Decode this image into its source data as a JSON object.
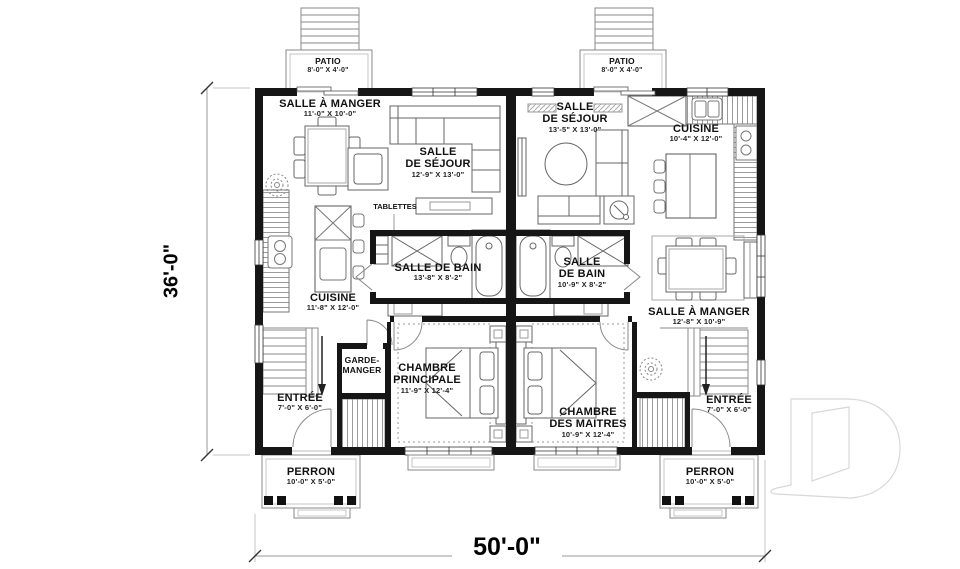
{
  "dimensions": {
    "overall_width": "50'-0\"",
    "overall_depth": "36'-0\""
  },
  "watermark_letter": "D",
  "left_unit": {
    "patio": {
      "name": "PATIO",
      "size": "8'-0\" X 4'-0\""
    },
    "dining": {
      "name": "SALLE À MANGER",
      "size": "11'-0\" X 10'-0\""
    },
    "living": {
      "line1": "SALLE",
      "line2": "DE SÉJOUR",
      "size": "12'-9\" X 13'-0\""
    },
    "shelves_label": "TABLETTES",
    "kitchen": {
      "name": "CUISINE",
      "size": "11'-8\" X 12'-0\""
    },
    "bath": {
      "name": "SALLE DE BAIN",
      "size": "13'-8\" X 8'-2\""
    },
    "pantry": {
      "line1": "GARDE-",
      "line2": "MANGER"
    },
    "entry": {
      "name": "ENTRÉE",
      "size": "7'-0\" X 6'-0\""
    },
    "bedroom": {
      "line1": "CHAMBRE",
      "line2": "PRINCIPALE",
      "size": "11'-9\" X 12'-4\""
    },
    "porch": {
      "name": "PERRON",
      "size": "10'-0\" X 5'-0\""
    }
  },
  "right_unit": {
    "patio": {
      "name": "PATIO",
      "size": "8'-0\" X 4'-0\""
    },
    "living": {
      "line1": "SALLE",
      "line2": "DE SÉJOUR",
      "size": "13'-5\" X 13'-0\""
    },
    "kitchen": {
      "name": "CUISINE",
      "size": "10'-4\" X 12'-0\""
    },
    "bath": {
      "line1": "SALLE",
      "line2": "DE BAIN",
      "size": "10'-9\" X 8'-2\""
    },
    "dining": {
      "name": "SALLE À MANGER",
      "size": "12'-8\" X 10'-9\""
    },
    "bedroom": {
      "line1": "CHAMBRE",
      "line2": "DES MAITRES",
      "size": "10'-9\" X 12'-4\""
    },
    "entry": {
      "name": "ENTRÉE",
      "size": "7'-0\" X 6'-0\""
    },
    "porch": {
      "name": "PERRON",
      "size": "10'-0\" X 5'-0\""
    }
  }
}
